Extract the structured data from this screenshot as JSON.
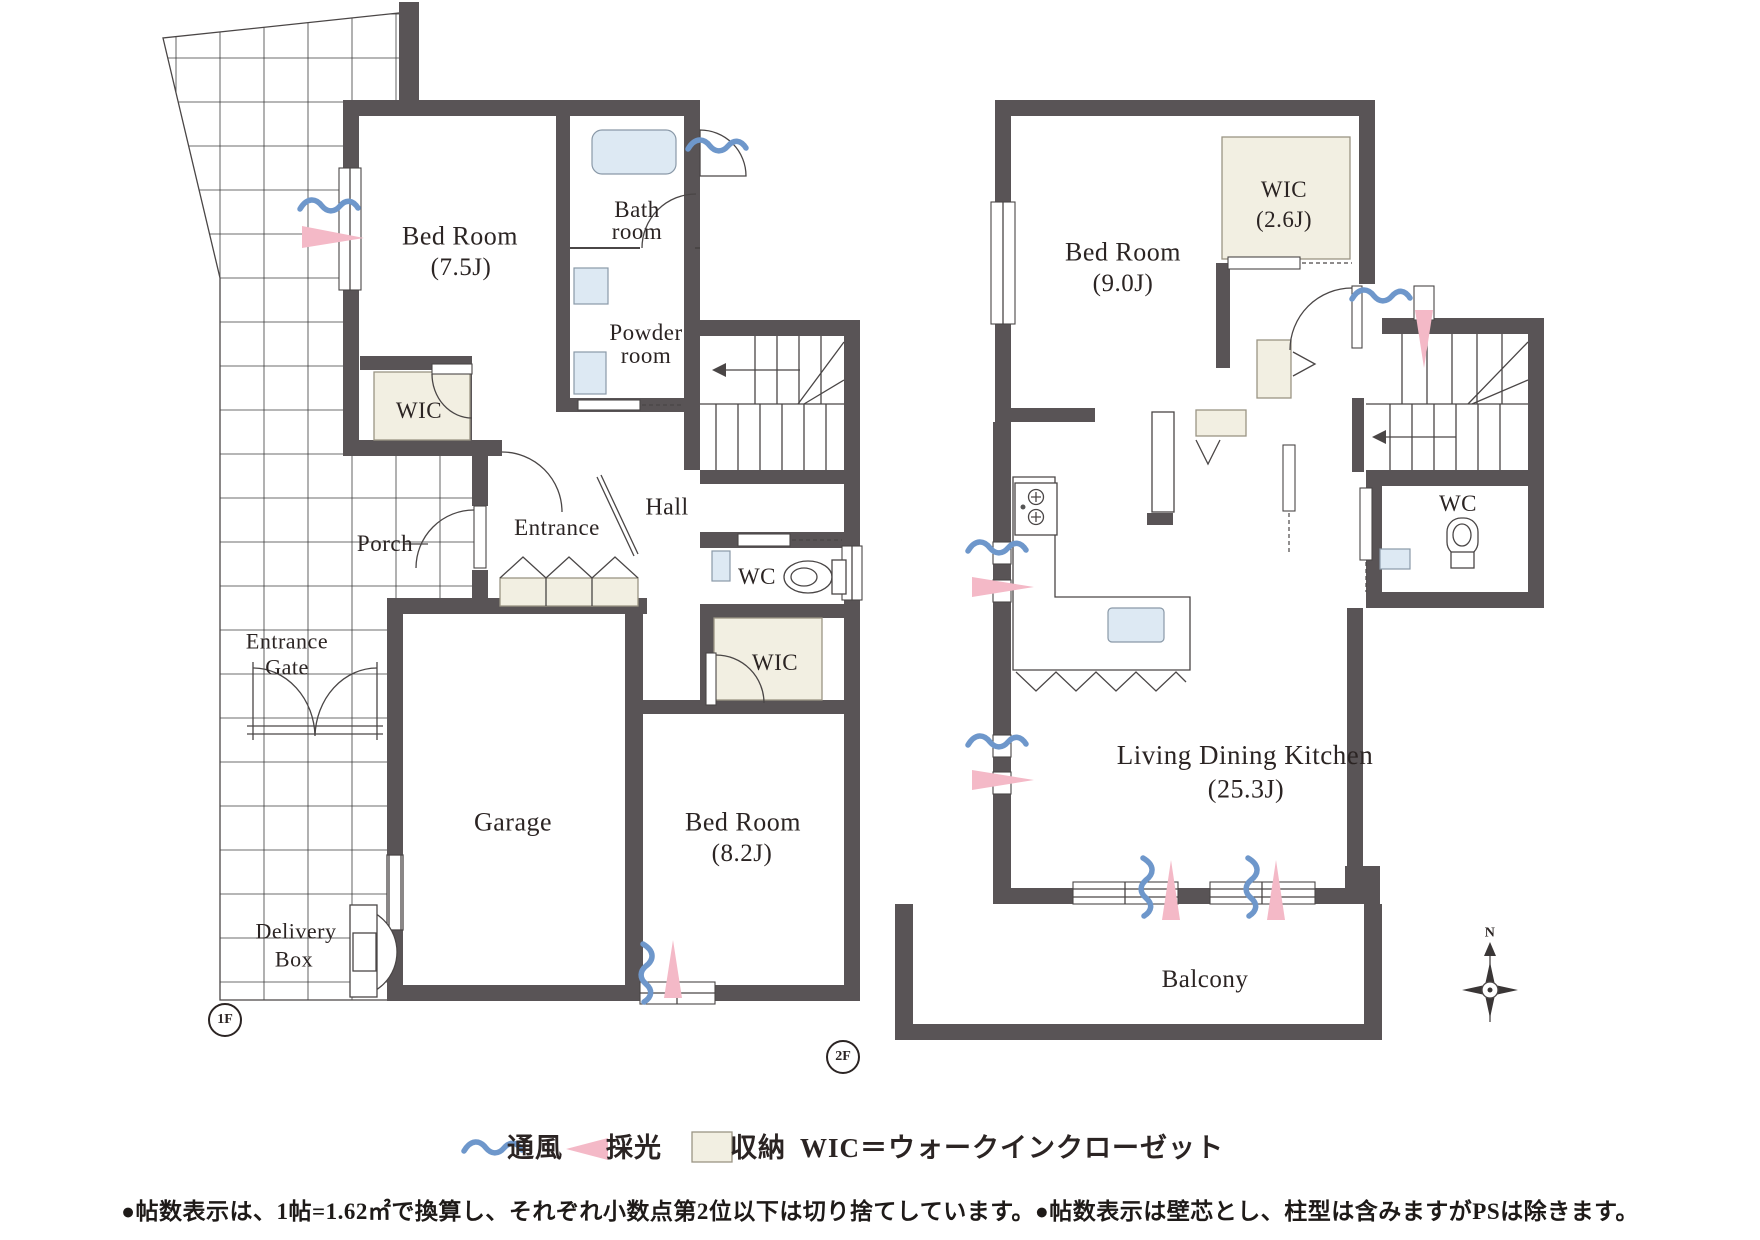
{
  "colors": {
    "wall": "#595456",
    "closet_fill": "#f2efe2",
    "fixture_fill": "#dde9f3",
    "vent_blue": "#6e97cb",
    "daylight_pink": "#f4b9c7",
    "text": "#2b2423"
  },
  "floor1": {
    "floor_label": "1F",
    "rooms": {
      "bedroom1": {
        "name": "Bed Room",
        "size": "(7.5J)"
      },
      "bathroom": {
        "line1": "Bath",
        "line2": "room"
      },
      "powder_room": {
        "line1": "Powder",
        "line2": "room"
      },
      "wic_bedroom": "WIC",
      "hall": "Hall",
      "entrance": "Entrance",
      "porch": "Porch",
      "entrance_gate": {
        "line1": "Entrance",
        "line2": "Gate"
      },
      "wc": "WC",
      "wic_hall": "WIC",
      "garage": "Garage",
      "bedroom2": {
        "name": "Bed Room",
        "size": "(8.2J)"
      },
      "delivery_box": {
        "line1": "Delivery",
        "line2": "Box"
      }
    }
  },
  "floor2": {
    "floor_label": "2F",
    "compass_north": "N",
    "rooms": {
      "bedroom": {
        "name": "Bed Room",
        "size": "(9.0J)"
      },
      "wic": {
        "name": "WIC",
        "size": "(2.6J)"
      },
      "wc": "WC",
      "ldk": {
        "name": "Living Dining Kitchen",
        "size": "(25.3J)"
      },
      "balcony": "Balcony"
    }
  },
  "legend": {
    "vent": "通風",
    "daylight": "採光",
    "storage": "収納",
    "wic_definition": "WIC＝ウォークインクローゼット"
  },
  "footnote": "●帖数表示は、1帖=1.62㎡で換算し、それぞれ小数点第2位以下は切り捨てしています。●帖数表示は壁芯とし、柱型は含みますがPSは除きます。"
}
